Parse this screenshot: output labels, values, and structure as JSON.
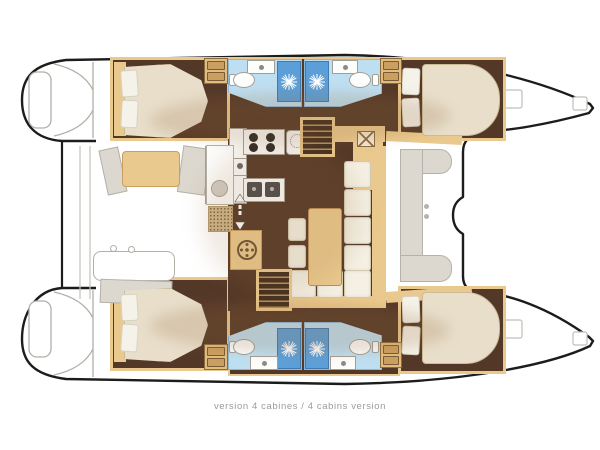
{
  "caption": "version 4 cabines / 4 cabins version",
  "plan": {
    "boat_type": "catamaran deck plan",
    "cabins": 4,
    "bathrooms": 4,
    "showers": 4
  },
  "palette": {
    "outline": "#1c1c1c",
    "gray-line": "#b2afa7",
    "gray-faint": "#c6c3bb",
    "brown": "#543827",
    "brown-dark": "#3f2b1e",
    "tan": "#eac98e",
    "tan-dark": "#c79f5f",
    "tan-deep": "#8a6a40",
    "mattress": "#e8deca",
    "mattress-bd": "#cabc96",
    "pillow": "#f5f2e9",
    "sofa": "#f4f0e3",
    "sofa-bd": "#d2c9ae",
    "bath": "#bedff2",
    "bath-bd": "#8fb8d8",
    "shower": "#5c9fd8",
    "shower-bd": "#3f7ab0",
    "white-fix": "#fdfdfc",
    "fix-bd": "#a29f97",
    "deck": "#dcd8cf",
    "deck-bd": "#b5b2aa",
    "stair": "#402c1e",
    "caption": "#9b9b9b"
  }
}
